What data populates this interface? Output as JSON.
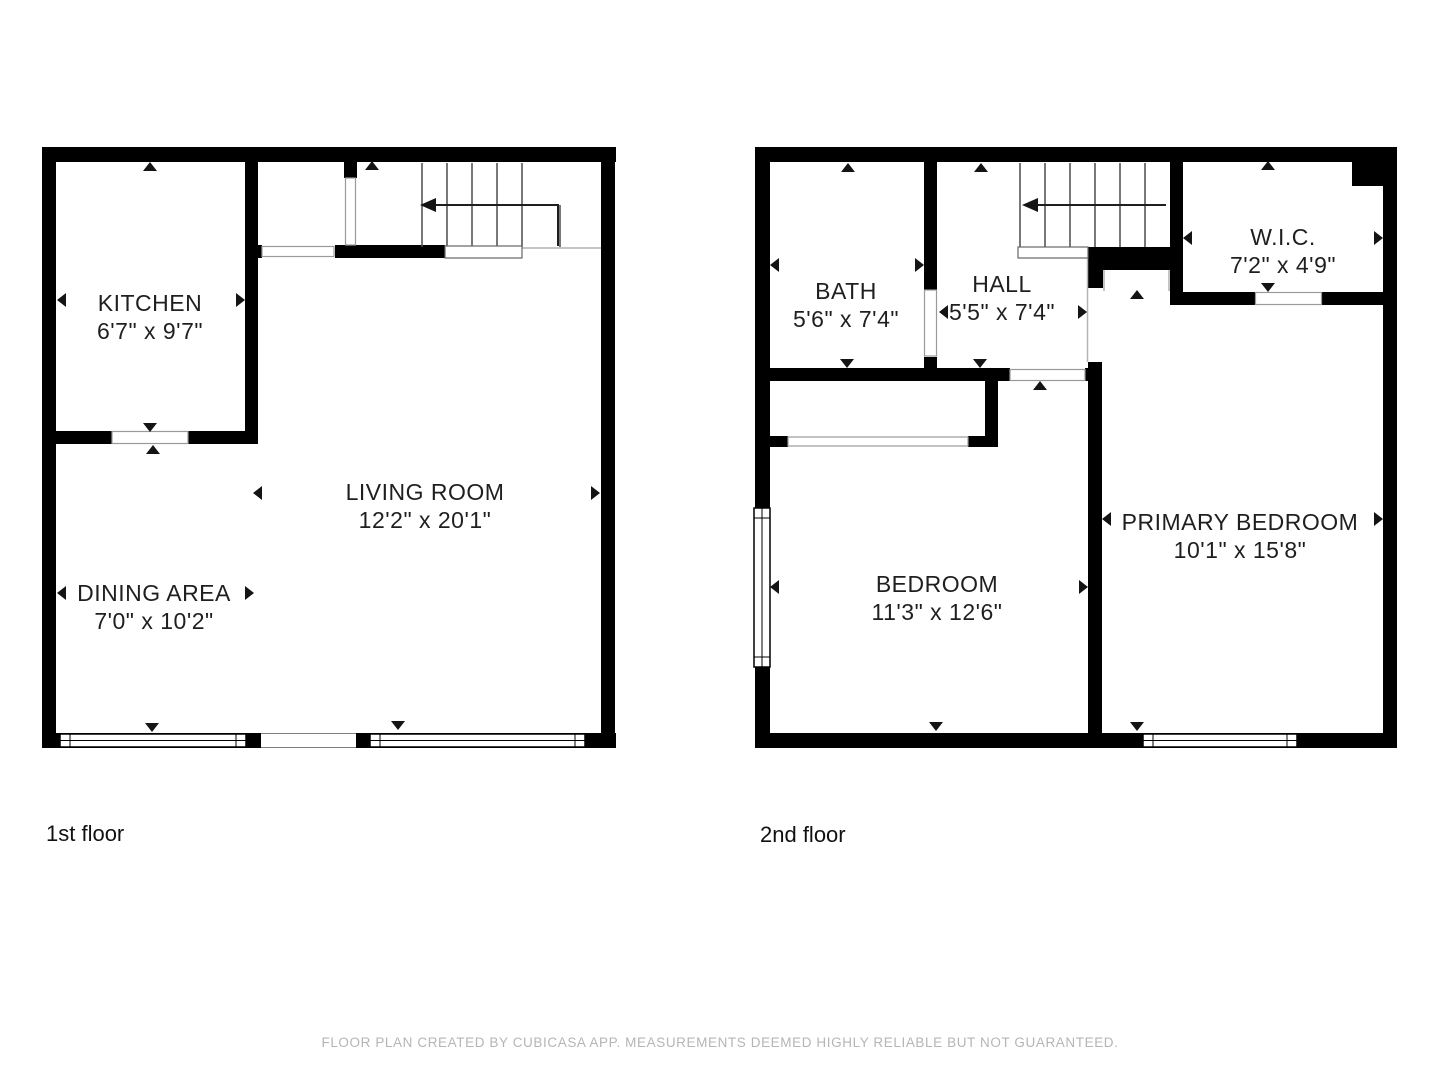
{
  "meta": {
    "background_color": "#ffffff",
    "wall_color": "#000000",
    "label_color": "#1f1f1f",
    "muted_color": "#b5b5b5"
  },
  "floor1": {
    "label": "1st floor",
    "rooms": [
      {
        "name": "KITCHEN",
        "dims": "6'7\" x 9'7\""
      },
      {
        "name": "LIVING ROOM",
        "dims": "12'2\" x 20'1\""
      },
      {
        "name": "DINING AREA",
        "dims": "7'0\" x 10'2\""
      }
    ]
  },
  "floor2": {
    "label": "2nd floor",
    "rooms": [
      {
        "name": "BATH",
        "dims": "5'6\" x 7'4\""
      },
      {
        "name": "HALL",
        "dims": "5'5\" x 7'4\""
      },
      {
        "name": "W.I.C.",
        "dims": "7'2\" x 4'9\""
      },
      {
        "name": "BEDROOM",
        "dims": "11'3\" x 12'6\""
      },
      {
        "name": "PRIMARY BEDROOM",
        "dims": "10'1\" x 15'8\""
      }
    ]
  },
  "footer": {
    "disclaimer": "FLOOR PLAN CREATED BY CUBICASA APP. MEASUREMENTS DEEMED HIGHLY RELIABLE BUT NOT GUARANTEED."
  }
}
